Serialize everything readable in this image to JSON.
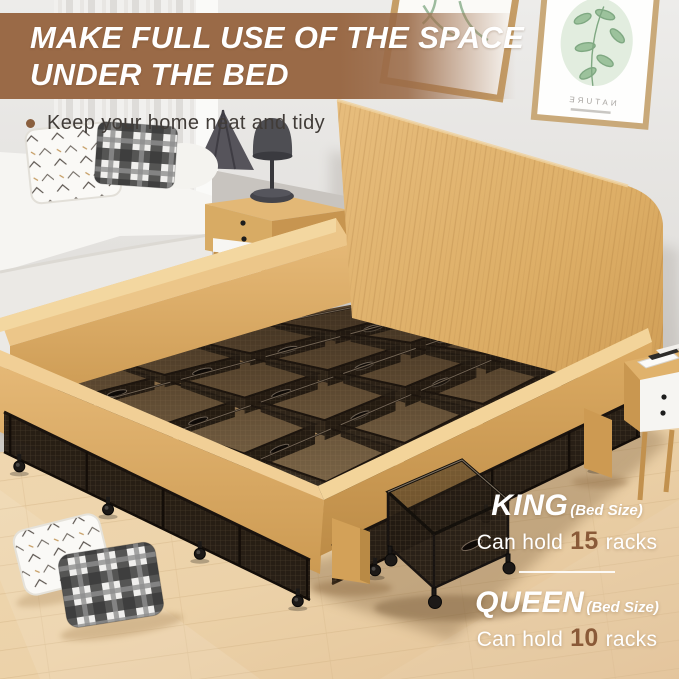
{
  "banner": {
    "line1": "MAKE FULL USE OF THE SPACE",
    "line2": "UNDER THE BED",
    "background_color": "#9a6a47",
    "text_color": "#ffffff"
  },
  "tagline": {
    "text": "Keep your home neat and tidy",
    "bullet_color": "#8a5f3e"
  },
  "size_info": [
    {
      "size": "KING",
      "suffix": "(Bed Size)",
      "prefix": "Can hold",
      "count": "15",
      "unit": "racks"
    },
    {
      "size": "QUEEN",
      "suffix": "(Bed Size)",
      "prefix": "Can hold",
      "count": "10",
      "unit": "racks"
    }
  ],
  "accent_number_color": "#8a5a38",
  "wall_art": {
    "label": "NATURE"
  },
  "scene_colors": {
    "wood": "#ddab66",
    "mesh_bin": "#241b12",
    "floor": "#ecd2a9",
    "wall": "#e5e3e0"
  }
}
